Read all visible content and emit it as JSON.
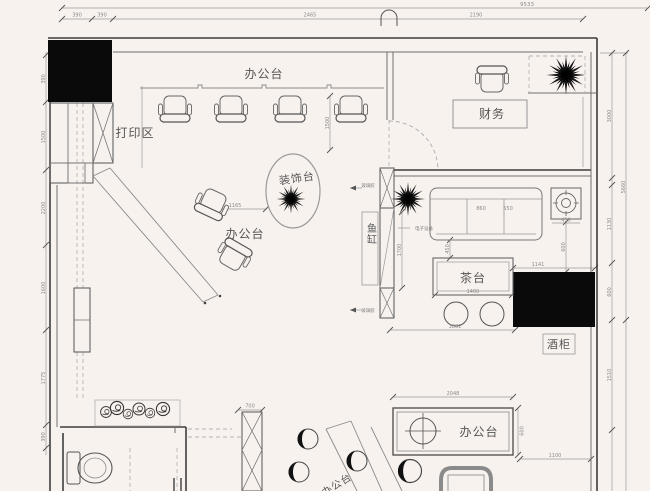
{
  "palette": {
    "background": "#f8f2ef",
    "wall_line": "#3d3d3d",
    "furniture_line": "#777777",
    "dim_line": "#999999",
    "label_text": "#4a4a4a",
    "mask_fill": "#0a0a0a"
  },
  "labels": {
    "office_top": "办公台",
    "print_area": "打印区",
    "decor": "装饰台",
    "office_mid": "办公台",
    "finance": "财务",
    "fish": "鱼缸",
    "tea": "茶台",
    "wine": "酒柜",
    "office_right": "办公台",
    "office_bottom": "办公台"
  },
  "notes": {
    "glass": "玻璃胶",
    "elec": "电子设备"
  },
  "dims": {
    "top": {
      "total": "9533",
      "s1": "390",
      "s2": "390",
      "s3": "2465",
      "s4": "2190"
    },
    "left": {
      "l1": "390",
      "l2": "1500",
      "l3": "2200",
      "l4": "1600",
      "l5": "1775",
      "l6": "390"
    },
    "right": {
      "r1": "3000",
      "r2": "1130",
      "r3": "600",
      "r4": "1510",
      "ro": "5660"
    },
    "inner": {
      "sofa_a": "860",
      "sofa_b": "550",
      "side_w": "450",
      "side_h": "600",
      "gap": "450",
      "tea_w": "1400",
      "tea_b": "1801",
      "box_w": "1141",
      "desk_w": "2048",
      "desk_h": "600",
      "desk_r": "1100",
      "col": "700",
      "mid": "1165",
      "chairs_v": "1500",
      "fish_v": "1700"
    }
  }
}
